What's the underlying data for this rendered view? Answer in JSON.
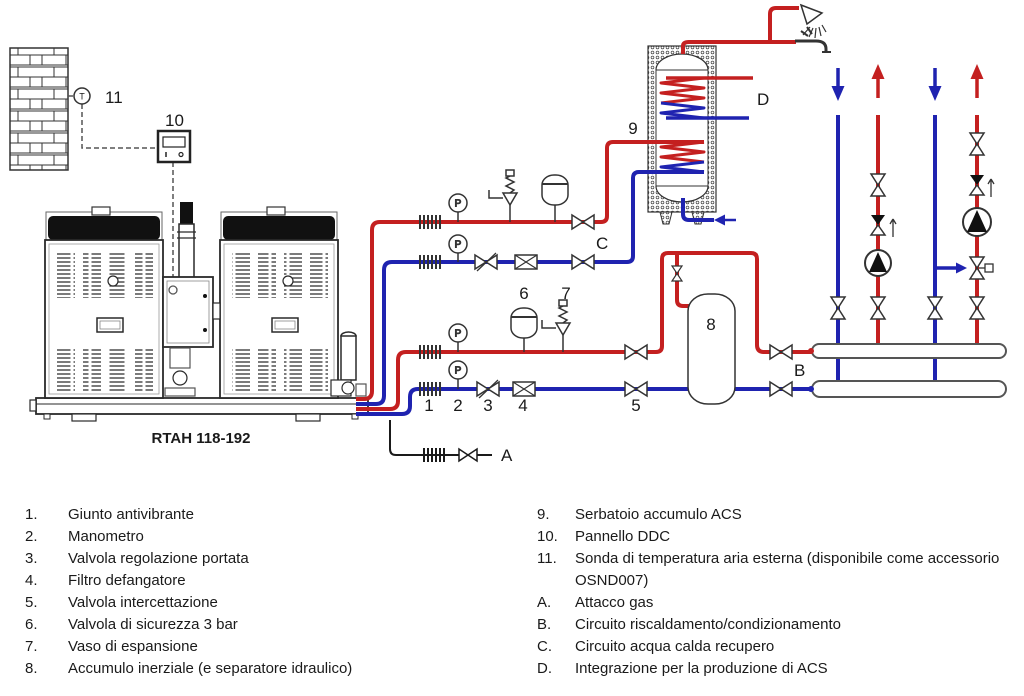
{
  "diagram": {
    "unit_label": "RTAH 118-192",
    "gauge_label": "P",
    "sensor_label": "T",
    "callouts": {
      "c1": "1",
      "c2": "2",
      "c3": "3",
      "c4": "4",
      "c5": "5",
      "c6": "6",
      "c7": "7",
      "c8": "8",
      "c9": "9",
      "c10": "10",
      "c11": "11",
      "cA": "A",
      "cB": "B",
      "cC": "C",
      "cD": "D"
    }
  },
  "legend": {
    "left": [
      {
        "num": "1.",
        "text": "Giunto antivibrante"
      },
      {
        "num": "2.",
        "text": "Manometro"
      },
      {
        "num": "3.",
        "text": "Valvola regolazione portata"
      },
      {
        "num": "4.",
        "text": "Filtro defangatore"
      },
      {
        "num": "5.",
        "text": "Valvola intercettazione"
      },
      {
        "num": "6.",
        "text": "Valvola di sicurezza 3 bar"
      },
      {
        "num": "7.",
        "text": "Vaso di espansione"
      },
      {
        "num": "8.",
        "text": "Accumulo inerziale (e separatore idraulico)"
      }
    ],
    "right": [
      {
        "num": "9.",
        "text": "Serbatoio accumulo ACS"
      },
      {
        "num": "10.",
        "text": "Pannello DDC"
      },
      {
        "num": "11.",
        "text": "Sonda di temperatura aria esterna (disponibile come accessorio OSND007)"
      },
      {
        "num": "A.",
        "text": "Attacco gas"
      },
      {
        "num": "B.",
        "text": "Circuito riscaldamento/condizionamento"
      },
      {
        "num": "C.",
        "text": "Circuito acqua calda recupero"
      },
      {
        "num": "D.",
        "text": "Integrazione per la produzione di ACS"
      }
    ]
  },
  "colors": {
    "hot": "#c42020",
    "cold": "#1f23b0",
    "line": "#2a2a2a"
  }
}
